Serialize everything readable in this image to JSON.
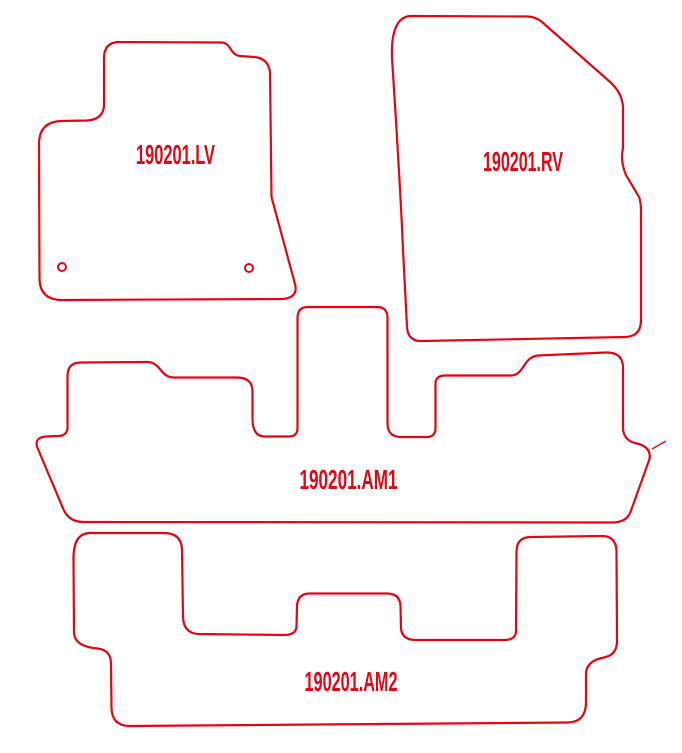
{
  "page": {
    "background_color": "#ffffff",
    "outline_color": "#e30613"
  },
  "mats": {
    "front_left": {
      "label": "190201.LV",
      "fixing_holes": 2
    },
    "front_right": {
      "label": "190201.RV"
    },
    "rear_row1": {
      "label": "190201.AM1"
    },
    "rear_row2": {
      "label": "190201.AM2"
    }
  }
}
